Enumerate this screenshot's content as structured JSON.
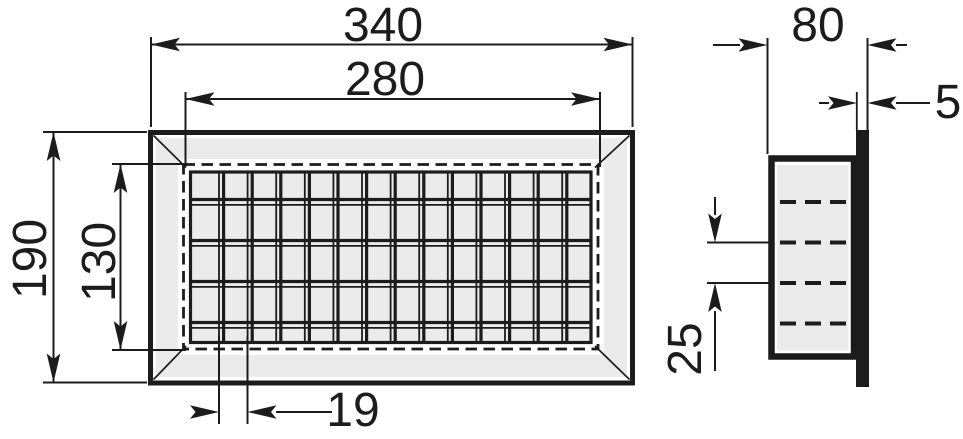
{
  "drawing": {
    "type": "technical-dimension-drawing",
    "subject": "rectangular-slatted-ventilation-grille",
    "views": [
      "front-view",
      "side-view"
    ]
  },
  "colors": {
    "line": "#1c1c1c",
    "face_fill": "#ebebeb",
    "background": "#ffffff"
  },
  "dimensions": {
    "outer_width": "340",
    "inner_width": "280",
    "outer_height": "190",
    "inner_height": "130",
    "slat_pitch": "19",
    "depth": "80",
    "flange_thickness": "5",
    "row_spacing": "25"
  }
}
